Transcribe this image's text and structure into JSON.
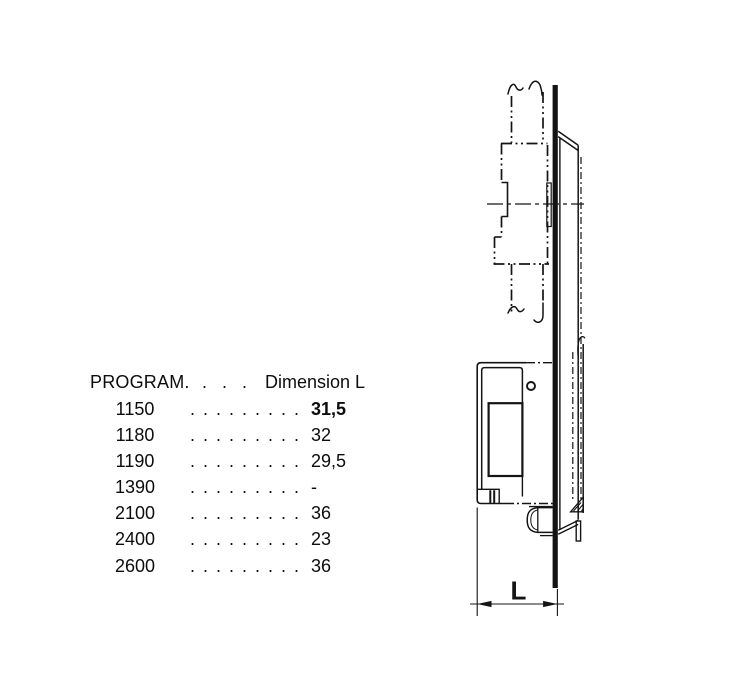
{
  "colors": {
    "ink": "#141414"
  },
  "table": {
    "header": {
      "program": "PROGRAM.",
      "dots": "...",
      "dimension": "Dimension L"
    },
    "rows": [
      {
        "program": "1150",
        "dots": ".........",
        "value": "31,5"
      },
      {
        "program": "1180",
        "dots": ".........",
        "value": "32"
      },
      {
        "program": "1190",
        "dots": ".........",
        "value": "29,5"
      },
      {
        "program": "1390",
        "dots": ".........",
        "value": "-"
      },
      {
        "program": "2100",
        "dots": ".........",
        "value": "36"
      },
      {
        "program": "2400",
        "dots": ".........",
        "value": "23"
      },
      {
        "program": "2600",
        "dots": ".........",
        "value": "36"
      }
    ]
  },
  "diagram": {
    "dimension_label": "L"
  }
}
